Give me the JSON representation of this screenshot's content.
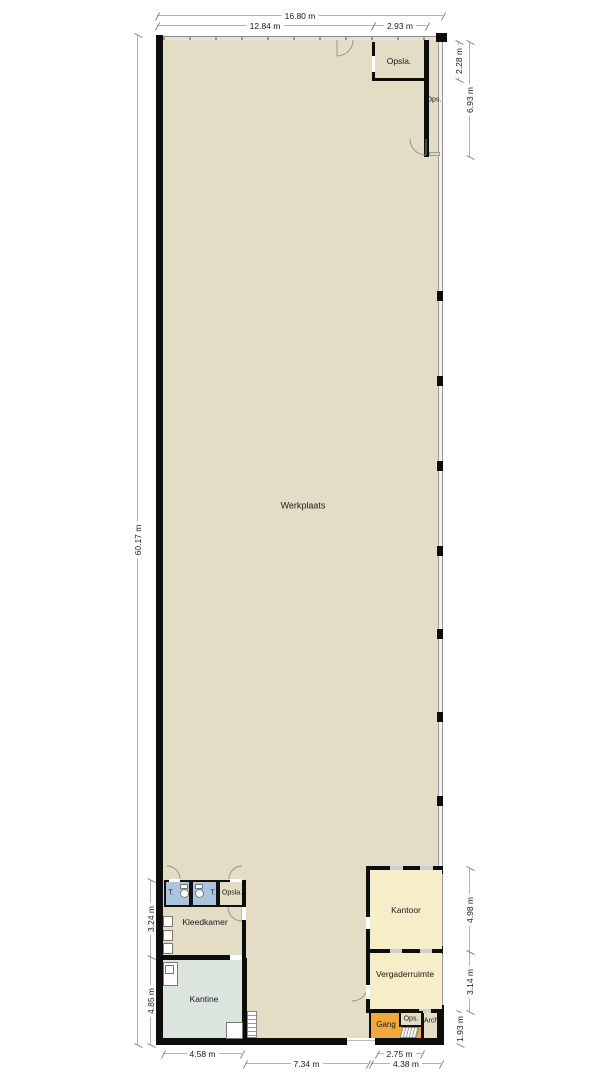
{
  "colors": {
    "floor": "#e3ddc5",
    "wetroom": "#aac6df",
    "kantine_fill": "#dce5dd",
    "office_fill": "#f6edc9",
    "gang_fill": "#f1a93c",
    "wall": "#0d0d0d",
    "dimline": "#b3b3b3",
    "text": "#1a1a1a"
  },
  "rooms": {
    "werkplaats": "Werkplaats",
    "opslag_top": "Opsla.",
    "ops_top": "Ops.",
    "toilet_left": "T.",
    "toilet_right": "T.",
    "opslag_mid": "Opsla.",
    "kleedkamer": "Kleedkamer",
    "kantine": "Kantine",
    "kantoor": "Kantoor",
    "vergaderruimte": "Vergaderruimte",
    "gang": "Gang",
    "ops_bottom": "Ops.",
    "archief": "Arch."
  },
  "dimensions": {
    "top_total": "16.80 m",
    "top_main": "12.84 m",
    "top_opslag": "2.93 m",
    "left_total": "60.17 m",
    "left_kleedkamer": "3.24 m",
    "left_kantine": "4.85 m",
    "right_opslag": "2.28 m",
    "right_ops": "6.93 m",
    "right_kantoor": "4.98 m",
    "right_vergaderruimte": "3.14 m",
    "right_gang": "1.93 m",
    "bottom_kantine": "4.58 m",
    "bottom_werkplaats": "7.34 m",
    "bottom_gang": "2.75 m",
    "bottom_entree": "4.38 m"
  }
}
